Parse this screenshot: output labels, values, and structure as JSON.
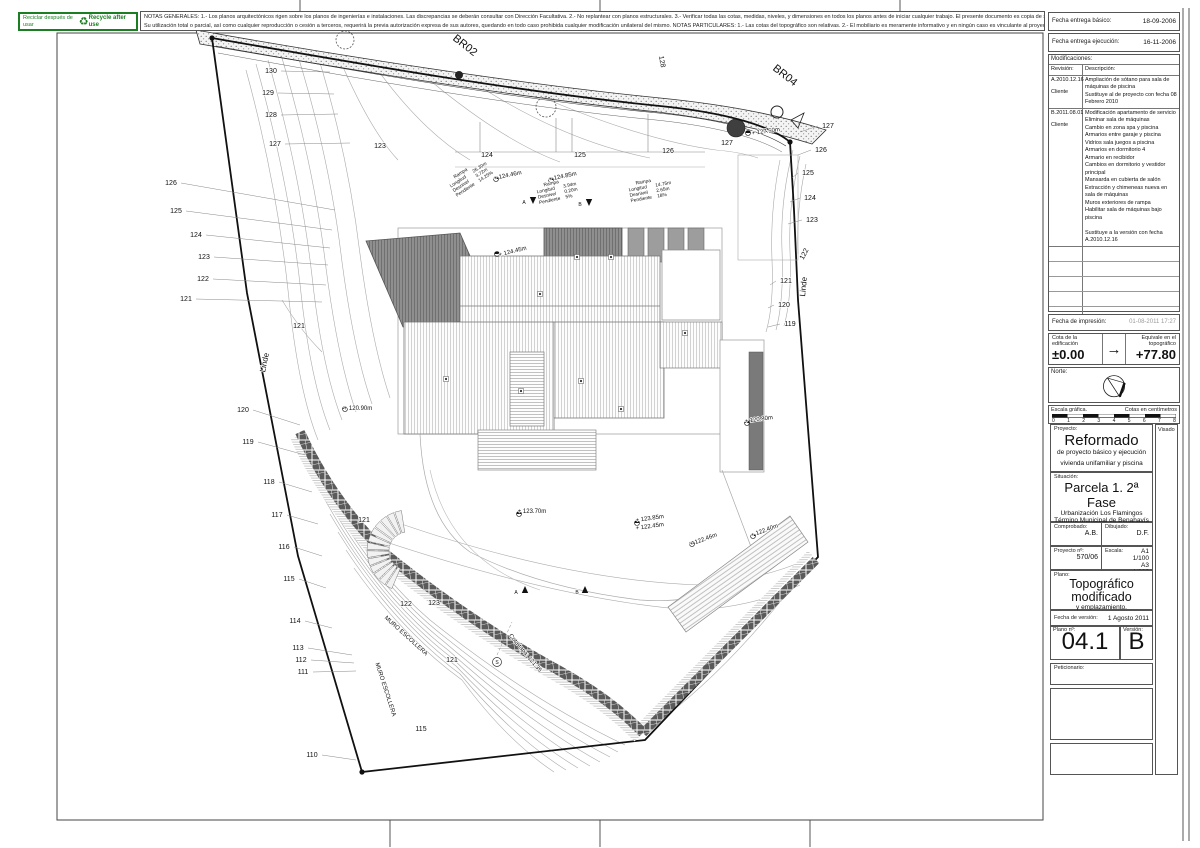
{
  "recycle": {
    "left": "Reciclar después de usar",
    "icon": "♻",
    "right": "Recycle after use",
    "color": "#1b7e22"
  },
  "notes": {
    "line1": "NOTAS GENERALES:   1.- Los planos arquitectónicos rigen sobre los planos de ingenierías e instalaciones. Las discrepancias se deberán consultar con Dirección Facultativa.   2.- No replantear con planos estructurales.   3.- Verificar todas las cotas, medidas, niveles, y dimensiones en todos los planos antes de iniciar cualquier trabajo. El presente documento es copia de su original del que son autores los arquitectos",
    "line2": "Su utilización total o parcial, así como cualquier reproducción o cesión a terceros, requerirá la previa autorización expresa de sus autores, quedando en todo caso prohibida cualquier modificación unilateral del mismo.   NOTAS PARTICULARES:   1.- Las cotas del topográfico son relativas.   2.- El mobiliario es meramente informativo y en ningún caso es vinculante al proyecto."
  },
  "titleblock": {
    "fecha_basico_label": "Fecha entrega básico:",
    "fecha_basico": "18-09-2006",
    "fecha_ejecucion_label": "Fecha entrega ejecución:",
    "fecha_ejecucion": "16-11-2006",
    "impresion_label": "Fecha de impresión:",
    "impresion": "01-08-2011 17:27",
    "cota_label": "Cota de la edificación",
    "cota": "±0.00",
    "arrow": "→",
    "equivale_label": "Equivale en el topográfico",
    "equivale": "+77.80",
    "norte_label": "Norte:",
    "escala_grafica_label": "Escala gráfica.",
    "cotas_cm_label": "Cotas en centímetros",
    "scale_ticks": [
      "0",
      "1",
      "2",
      "3",
      "4",
      "5",
      "6",
      "7",
      "8"
    ],
    "visado_label": "Visado"
  },
  "modifications": {
    "title": "Modificaciones:",
    "revision_label": "Revisión:",
    "descripcion_label": "Descripción:",
    "rows": [
      {
        "rev": "A.2010.12.16",
        "by": "Cliente",
        "desc": "Ampliación de sótano para sala de máquinas de piscina\nSustituye al de proyecto con fecha 08 Febrero 2010"
      },
      {
        "rev": "B.2011.08.01",
        "by": "Cliente",
        "desc": "Modificación apartamento de servicio\nEliminar sala de máquinas\nCambio en zona spa y piscina\nArmarios entre garaje y piscina\nVidrios sala juegos a piscina\nArmarios en dormitorio 4\nArmario en recibidor\nCambios en dormitorio y vestidor principal\nMansarda en cubierta de salón\nExtracción y chimeneas nueva en sala de máquinas\nMuros exteriores de rampa\nHabilitar sala de máquinas bajo piscina\n\nSustituye a la versión con fecha A.2010.12.16"
      }
    ]
  },
  "project": {
    "proyecto_label": "Proyecto:",
    "proyecto_title": "Reformado",
    "proyecto_sub1": "de proyecto básico y ejecución",
    "proyecto_sub2": "vivienda unifamiliar y piscina",
    "situacion_label": "Situación:",
    "situacion_title": "Parcela 1. 2ª Fase",
    "situacion_line1": "Urbanización Los Flamingos",
    "situacion_line2": "Término Municipal de Benahavís",
    "situacion_line3": "Málaga",
    "comprobado_label": "Comprobado:",
    "comprobado": "A.B.",
    "dibujado_label": "Dibujado:",
    "dibujado": "D.F.",
    "proyecto_num_label": "Proyecto nº:",
    "proyecto_num": "570/06",
    "escala_label": "Escala:",
    "escala1": "A1 1/100",
    "escala2": "A3 1/200",
    "plano_label": "Plano:",
    "plano_title1": "Topográfico",
    "plano_title2": "modificado",
    "plano_sub": "y emplazamiento.",
    "fecha_version_label": "Fecha de versión:",
    "fecha_version": "1 Agosto 2011",
    "plano_num_label": "Plano nº:",
    "plano_num": "04.1",
    "version_label": "Versión:",
    "version": "B",
    "peticionario_label": "Peticionario:"
  },
  "drawing": {
    "labels": [
      {
        "t": "130",
        "x": 271,
        "y": 73,
        "ld": [
          330,
          72
        ]
      },
      {
        "t": "129",
        "x": 268,
        "y": 95,
        "ld": [
          334,
          94
        ]
      },
      {
        "t": "128",
        "x": 271,
        "y": 117,
        "ld": [
          338,
          114
        ]
      },
      {
        "t": "127",
        "x": 275,
        "y": 146,
        "ld": [
          350,
          143
        ]
      },
      {
        "t": "126",
        "x": 171,
        "y": 185,
        "ld": [
          335,
          210
        ]
      },
      {
        "t": "125",
        "x": 176,
        "y": 213,
        "ld": [
          332,
          230
        ]
      },
      {
        "t": "124",
        "x": 196,
        "y": 237,
        "ld": [
          330,
          248
        ]
      },
      {
        "t": "123",
        "x": 204,
        "y": 259,
        "ld": [
          328,
          265
        ]
      },
      {
        "t": "122",
        "x": 203,
        "y": 281,
        "ld": [
          326,
          285
        ]
      },
      {
        "t": "121",
        "x": 186,
        "y": 301,
        "ld": [
          322,
          302
        ]
      },
      {
        "t": "120",
        "x": 243,
        "y": 412,
        "ld": [
          300,
          425
        ]
      },
      {
        "t": "119",
        "x": 248,
        "y": 444,
        "ld": [
          305,
          455
        ]
      },
      {
        "t": "118",
        "x": 269,
        "y": 484,
        "ld": [
          312,
          492
        ]
      },
      {
        "t": "117",
        "x": 277,
        "y": 517,
        "ld": [
          318,
          524
        ]
      },
      {
        "t": "116",
        "x": 284,
        "y": 549,
        "ld": [
          322,
          556
        ]
      },
      {
        "t": "115",
        "x": 289,
        "y": 581,
        "ld": [
          326,
          588
        ]
      },
      {
        "t": "114",
        "x": 295,
        "y": 623,
        "ld": [
          332,
          628
        ]
      },
      {
        "t": "113",
        "x": 298,
        "y": 650,
        "ld": [
          352,
          655
        ]
      },
      {
        "t": "112",
        "x": 301,
        "y": 662,
        "ld": [
          354,
          663
        ]
      },
      {
        "t": "111",
        "x": 303,
        "y": 674,
        "ld": [
          356,
          671
        ]
      },
      {
        "t": "110",
        "x": 312,
        "y": 757,
        "ld": [
          356,
          760
        ]
      },
      {
        "t": "121",
        "x": 299,
        "y": 328
      },
      {
        "t": "121",
        "x": 364,
        "y": 522
      },
      {
        "t": "122",
        "x": 406,
        "y": 606
      },
      {
        "t": "123",
        "x": 434,
        "y": 605
      },
      {
        "t": "121",
        "x": 452,
        "y": 662
      },
      {
        "t": "115",
        "x": 421,
        "y": 731
      },
      {
        "t": "123",
        "x": 380,
        "y": 148
      },
      {
        "t": "124",
        "x": 487,
        "y": 157
      },
      {
        "t": "125",
        "x": 580,
        "y": 157
      },
      {
        "t": "126",
        "x": 668,
        "y": 153
      },
      {
        "t": "127",
        "x": 727,
        "y": 145
      },
      {
        "t": "127",
        "x": 828,
        "y": 128,
        "ld": [
          800,
          132
        ]
      },
      {
        "t": "126",
        "x": 821,
        "y": 152,
        "ld": [
          798,
          155
        ]
      },
      {
        "t": "125",
        "x": 808,
        "y": 175,
        "ld": [
          792,
          178
        ]
      },
      {
        "t": "124",
        "x": 810,
        "y": 200,
        "ld": [
          790,
          202
        ]
      },
      {
        "t": "123",
        "x": 812,
        "y": 222,
        "ld": [
          788,
          224
        ]
      },
      {
        "t": "122",
        "x": 806,
        "y": 255,
        "r": -62
      },
      {
        "t": "121",
        "x": 786,
        "y": 283,
        "ld": [
          770,
          285
        ]
      },
      {
        "t": "120",
        "x": 784,
        "y": 307,
        "ld": [
          768,
          308
        ]
      },
      {
        "t": "119",
        "x": 790,
        "y": 326,
        "ld": [
          768,
          327
        ]
      },
      {
        "t": "BR02",
        "x": 463,
        "y": 48,
        "r": 38,
        "s": 11
      },
      {
        "t": "BR04",
        "x": 783,
        "y": 78,
        "r": 38,
        "s": 11
      },
      {
        "t": "128",
        "x": 660,
        "y": 62,
        "r": 80
      },
      {
        "t": "+ 127.50m",
        "x": 766,
        "y": 133,
        "r": -8,
        "s": 6
      },
      {
        "t": "Linde",
        "x": 267,
        "y": 363,
        "r": -78,
        "s": 8
      },
      {
        "t": "Linde",
        "x": 806,
        "y": 287,
        "r": -84,
        "s": 8
      },
      {
        "t": "MURO ESCOLLERA",
        "x": 405,
        "y": 637,
        "r": 42,
        "s": 6
      },
      {
        "t": "MURO ESCOLLERA",
        "x": 384,
        "y": 690,
        "r": 72,
        "s": 6
      },
      {
        "t": "+ 120.90m",
        "x": 358,
        "y": 410,
        "s": 6
      },
      {
        "t": "+ 124.45m",
        "x": 513,
        "y": 253,
        "r": -14,
        "s": 6
      },
      {
        "t": "+ 124.46m",
        "x": 508,
        "y": 177,
        "r": -12,
        "s": 6
      },
      {
        "t": "+ 124.85m",
        "x": 563,
        "y": 178,
        "r": -12,
        "s": 6
      },
      {
        "t": "+ 123.70m",
        "x": 532,
        "y": 513,
        "s": 6
      },
      {
        "t": "+ 123.85m",
        "x": 650,
        "y": 520,
        "r": -8,
        "s": 6
      },
      {
        "t": "+ 122.45m",
        "x": 650,
        "y": 528,
        "r": -8,
        "s": 6
      },
      {
        "t": "+ 122.46m",
        "x": 704,
        "y": 541,
        "r": -20,
        "s": 6
      },
      {
        "t": "+ 122.40m",
        "x": 765,
        "y": 532,
        "r": -20,
        "s": 6
      },
      {
        "t": "+ 120.80m",
        "x": 759,
        "y": 421,
        "r": -8,
        "s": 6
      },
      {
        "t": "Cota tapa: 121.35",
        "x": 524,
        "y": 654,
        "r": 50,
        "s": 6
      },
      {
        "t": "S",
        "x": 497,
        "y": 664,
        "s": 5
      },
      {
        "t": "A",
        "x": 524,
        "y": 204,
        "s": 5
      },
      {
        "t": "B",
        "x": 580,
        "y": 206,
        "s": 5
      },
      {
        "t": "A",
        "x": 516,
        "y": 594,
        "s": 5
      },
      {
        "t": "B",
        "x": 577,
        "y": 594,
        "s": 5
      }
    ],
    "ramps": [
      {
        "x": 448,
        "y": 183,
        "r": -33,
        "rows": [
          [
            "Rampa",
            ""
          ],
          [
            "Longitud",
            "26.30m"
          ],
          [
            "Desnivel",
            "3.72m"
          ],
          [
            "Pendiente",
            "14.25%"
          ]
        ]
      },
      {
        "x": 536,
        "y": 188,
        "r": -12,
        "rows": [
          [
            "Rampa",
            ""
          ],
          [
            "Longitud",
            "3.94m"
          ],
          [
            "Desnivel",
            "0.20m"
          ],
          [
            "Pendiente",
            "5%"
          ]
        ]
      },
      {
        "x": 628,
        "y": 186,
        "r": -10,
        "rows": [
          [
            "Rampa",
            ""
          ],
          [
            "Longitud",
            "14.75m"
          ],
          [
            "Desnivel",
            "2.65m"
          ],
          [
            "Pendiente",
            "18%"
          ]
        ]
      }
    ],
    "spot_markers": [
      [
        345,
        409
      ],
      [
        497,
        254
      ],
      [
        496,
        179
      ],
      [
        551,
        180
      ],
      [
        519,
        514
      ],
      [
        637,
        523
      ],
      [
        692,
        544
      ],
      [
        753,
        536
      ],
      [
        747,
        423
      ],
      [
        748,
        133
      ]
    ],
    "section_arrows": [
      [
        533,
        200,
        0
      ],
      [
        589,
        202,
        0
      ],
      [
        525,
        590,
        180
      ],
      [
        585,
        590,
        180
      ]
    ],
    "vents": [
      [
        540,
        294
      ],
      [
        577,
        257
      ],
      [
        611,
        257
      ],
      [
        685,
        333
      ],
      [
        446,
        379
      ],
      [
        521,
        391
      ],
      [
        581,
        381
      ],
      [
        621,
        409
      ]
    ],
    "manhole": {
      "x": 497,
      "y": 662
    }
  }
}
